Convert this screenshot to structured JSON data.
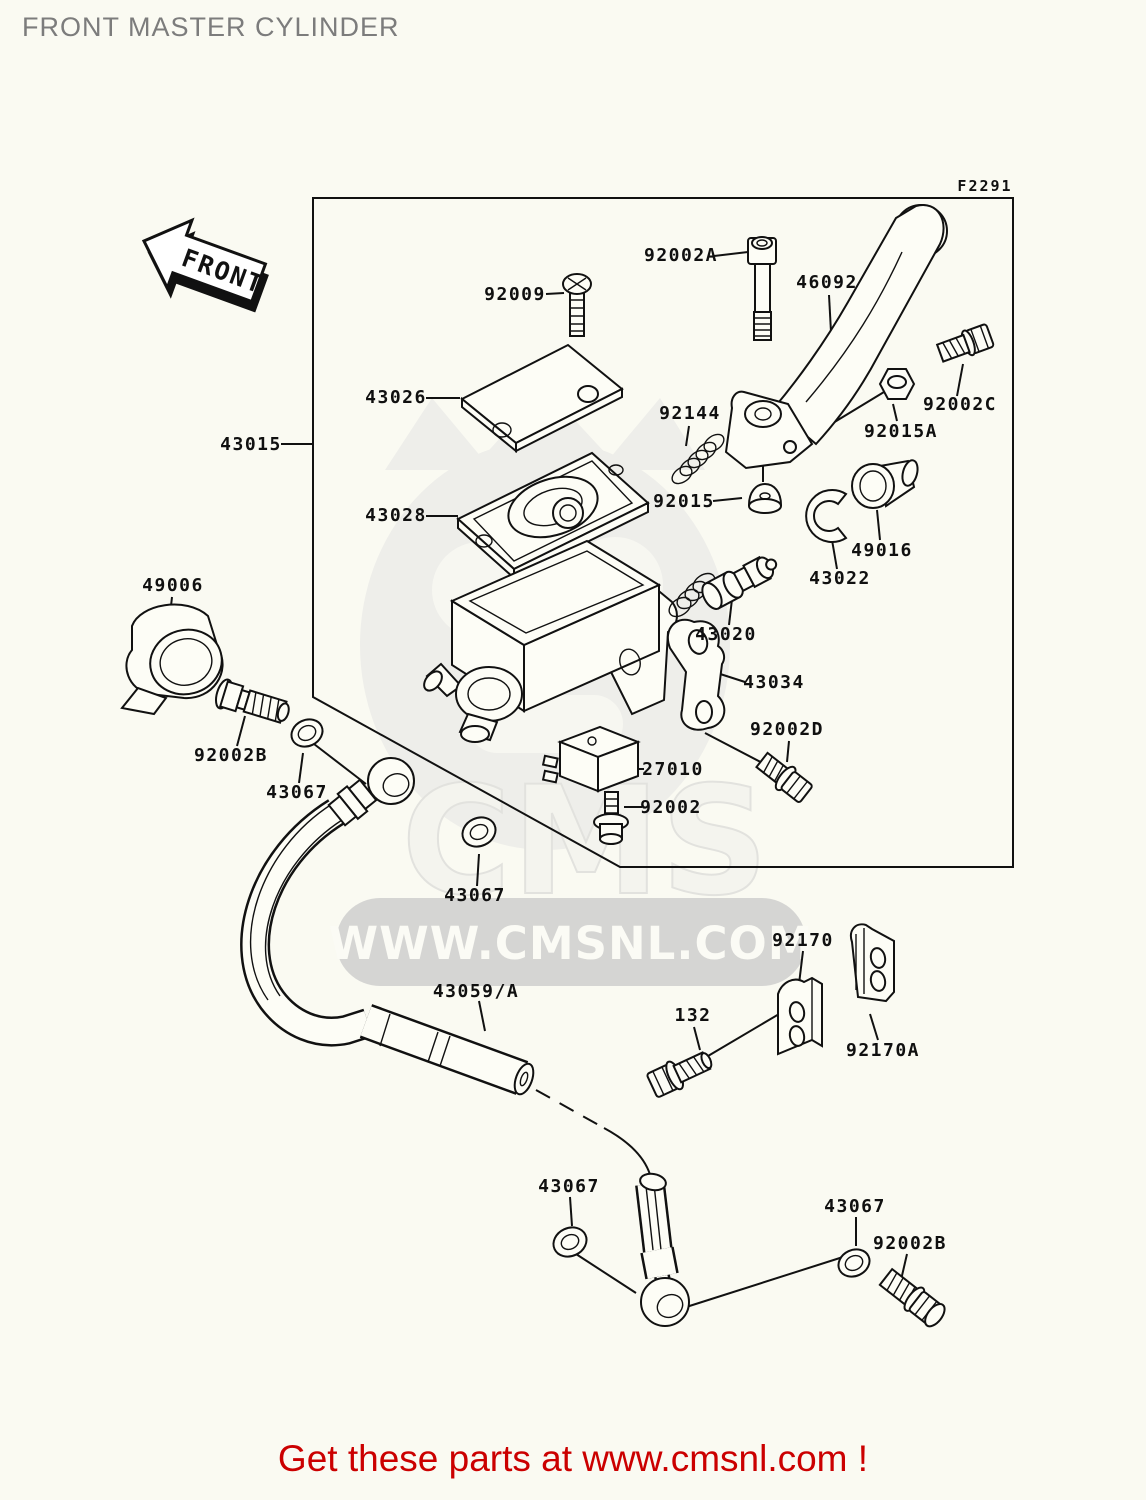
{
  "page": {
    "title": "FRONT MASTER CYLINDER",
    "figure_code": "F2291",
    "front_arrow_text": "FRONT",
    "footer_text": "Get these parts at www.cmsnl.com !"
  },
  "watermark": {
    "brand": "CMS",
    "url": "WWW.CMSNL.COM"
  },
  "colors": {
    "footer_red": "#cb0000",
    "line_black": "#111111",
    "background": "#fafaf2",
    "watermark_band_gray": "#d5d5d3"
  },
  "parts": [
    {
      "label": "92009"
    },
    {
      "label": "92002A"
    },
    {
      "label": "46092"
    },
    {
      "label": "43026"
    },
    {
      "label": "43028"
    },
    {
      "label": "92144"
    },
    {
      "label": "92015"
    },
    {
      "label": "92015A"
    },
    {
      "label": "92002C"
    },
    {
      "label": "49016"
    },
    {
      "label": "43022"
    },
    {
      "label": "43020"
    },
    {
      "label": "43015"
    },
    {
      "label": "43034"
    },
    {
      "label": "92002D"
    },
    {
      "label": "27010"
    },
    {
      "label": "92002"
    },
    {
      "label": "49006"
    },
    {
      "label": "92002B"
    },
    {
      "label": "43067"
    },
    {
      "label": "43067"
    },
    {
      "label": "43059/A"
    },
    {
      "label": "92170"
    },
    {
      "label": "132"
    },
    {
      "label": "92170A"
    },
    {
      "label": "43067"
    },
    {
      "label": "43067"
    },
    {
      "label": "92002B"
    }
  ]
}
